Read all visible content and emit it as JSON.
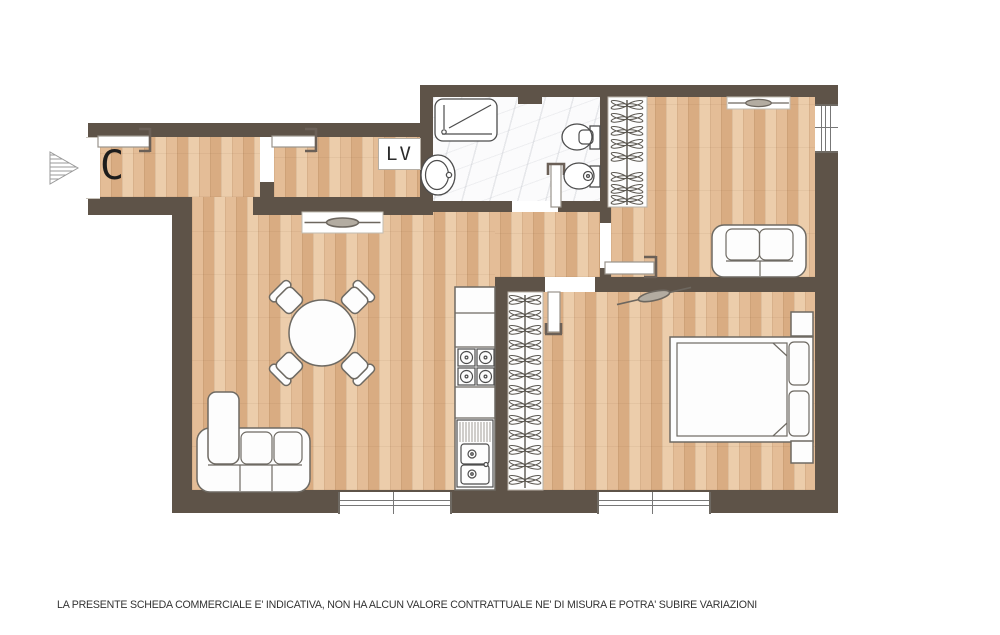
{
  "labels": {
    "camera_marker": "C",
    "washer": "LV"
  },
  "disclaimer": "LA PRESENTE SCHEDA COMMERCIALE E' INDICATIVA, NON HA ALCUN VALORE CONTRATTUALE NE' DI MISURA E POTRA' SUBIRE VARIAZIONI",
  "colors": {
    "wall": "#5e5348",
    "wood_floor": "#e4bd97",
    "wood_floor_dark": "#d9ac82",
    "wood_floor_light": "#eccdab",
    "marble_floor": "#fbfbfc",
    "furniture_stroke": "#6e6a63",
    "fixture_stroke": "#4d4d4d",
    "text": "#333333"
  }
}
